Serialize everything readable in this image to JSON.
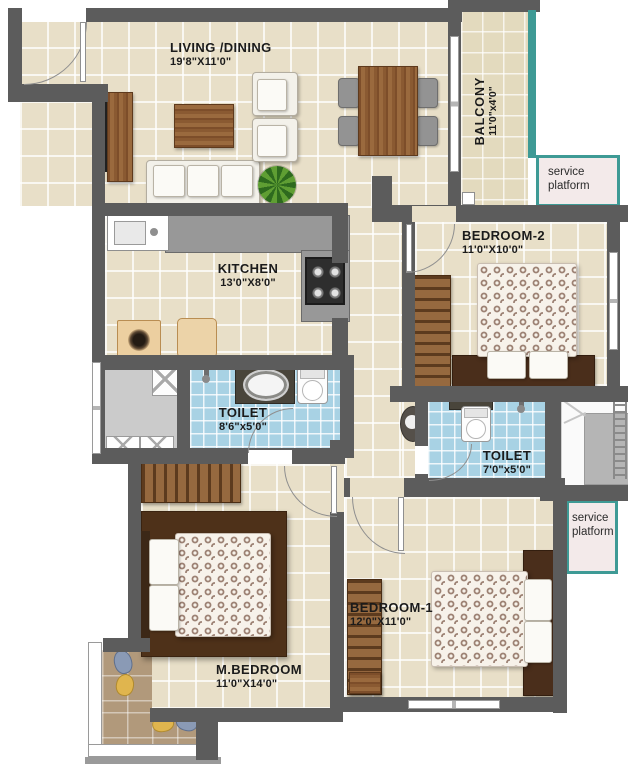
{
  "rooms": {
    "living": {
      "name": "LIVING /DINING",
      "dims": "19'8\"X11'0\""
    },
    "balcony": {
      "name": "BALCONY",
      "dims": "11'0\"x4'0\""
    },
    "bedroom2": {
      "name": "BEDROOM-2",
      "dims": "11'0\"X10'0\""
    },
    "kitchen": {
      "name": "KITCHEN",
      "dims": "13'0\"X8'0\""
    },
    "toilet1": {
      "name": "TOILET",
      "dims": "8'6\"x5'0\""
    },
    "toilet2": {
      "name": "TOILET",
      "dims": "7'0\"x5'0\""
    },
    "bedroom1": {
      "name": "BEDROOM-1",
      "dims": "12'0\"X11'0\""
    },
    "mbedroom": {
      "name": "M.BEDROOM",
      "dims": "11'0\"X14'0\""
    }
  },
  "annotations": {
    "service_platform_top": "service platform",
    "service_platform_mid": "service platform"
  },
  "colors": {
    "wall": "#5c5c5c",
    "floor_tile": "#e8dfc8",
    "toilet_tile": "#a8d2e4",
    "balcony_deck": "#b1997b",
    "teal_trim": "#3e9a95",
    "platform_bg": "#f3eaea"
  }
}
